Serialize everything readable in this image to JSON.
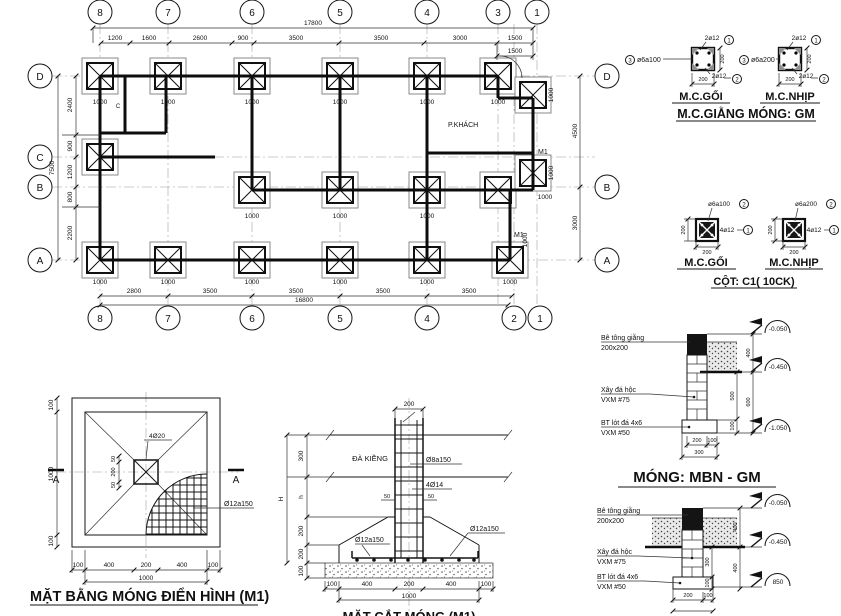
{
  "plan": {
    "grid_top": [
      "8",
      "7",
      "6",
      "5",
      "4",
      "3",
      "1"
    ],
    "grid_bottom": [
      "8",
      "7",
      "6",
      "5",
      "4",
      "2",
      "1"
    ],
    "grid_left": [
      "D",
      "C",
      "B",
      "A"
    ],
    "grid_right": [
      "D",
      "B",
      "A"
    ],
    "dim_total_top": "17800",
    "dims_top": [
      "1200",
      "1600",
      "2600",
      "900",
      "3500",
      "3500",
      "3000",
      "1500"
    ],
    "dim_1500_b": "1500",
    "dims_left": [
      "2400",
      "900",
      "1200",
      "800",
      "2200"
    ],
    "dim_total_left": "7500",
    "dim_right_db": "4500",
    "dim_right_ba": "3000",
    "dims_bottom": [
      "2800",
      "3500",
      "3500",
      "3500",
      "3500"
    ],
    "dim_total_bottom": "16800",
    "footing_w": "1000",
    "room": "P.KHÁCH",
    "m1": "M1",
    "c": "C"
  },
  "gm": {
    "title": "M.C.GIẰNG MÓNG: GM",
    "goi": "M.C.GỐI",
    "nhip": "M.C.NHỊP",
    "top_bar": "2ø12",
    "bot_bar": "2ø12",
    "st_goi": "ø6a100",
    "st_nhip": "ø6a200",
    "w": "200",
    "h": "200",
    "c1": "1",
    "c2": "2",
    "c3": "3"
  },
  "c1": {
    "title": "CỘT: C1( 10CK)",
    "goi": "M.C.GỐI",
    "nhip": "M.C.NHỊP",
    "st_goi": "ø6a100",
    "st_nhip": "ø6a200",
    "bars": "4ø12",
    "w": "200",
    "h": "200",
    "n1": "1",
    "n2": "2"
  },
  "m1plan": {
    "title": "MẶT BẰNG MÓNG ĐIỂN HÌNH (M1)",
    "bars": "4Ø20",
    "mesh": "Ø12a150",
    "sec": "A",
    "d100": "100",
    "d400": "400",
    "d200": "200",
    "d1000": "1000",
    "d50": "50"
  },
  "sect": {
    "top": "200",
    "beam": "ĐÀ KIỀNG",
    "stirrup": "Ø8a150",
    "bars": "4Ø14",
    "off": "50",
    "mesh": "Ø12a150",
    "H": "H",
    "h": "h",
    "d300": "300",
    "d200": "200",
    "d100": "100",
    "d400": "400",
    "d1000": "1000",
    "caption": "MẶT CẮT MÓNG (M1)"
  },
  "mbn": {
    "title": "MÓNG: MBN - GM",
    "giang1": "Bê tông giằng",
    "giang2": "200x200",
    "dahoc1": "Xây đá hộc",
    "dahoc2": "VXM #75",
    "lot1": "BT lót đá 4x6",
    "lot2": "VXM #50",
    "lv1": "-0.050",
    "lv2": "-0.450",
    "lv3": "-1.050",
    "lv3b": "850",
    "d400": "400",
    "d500": "500",
    "d600": "600",
    "d300": "300",
    "d200": "200",
    "d100": "100"
  }
}
